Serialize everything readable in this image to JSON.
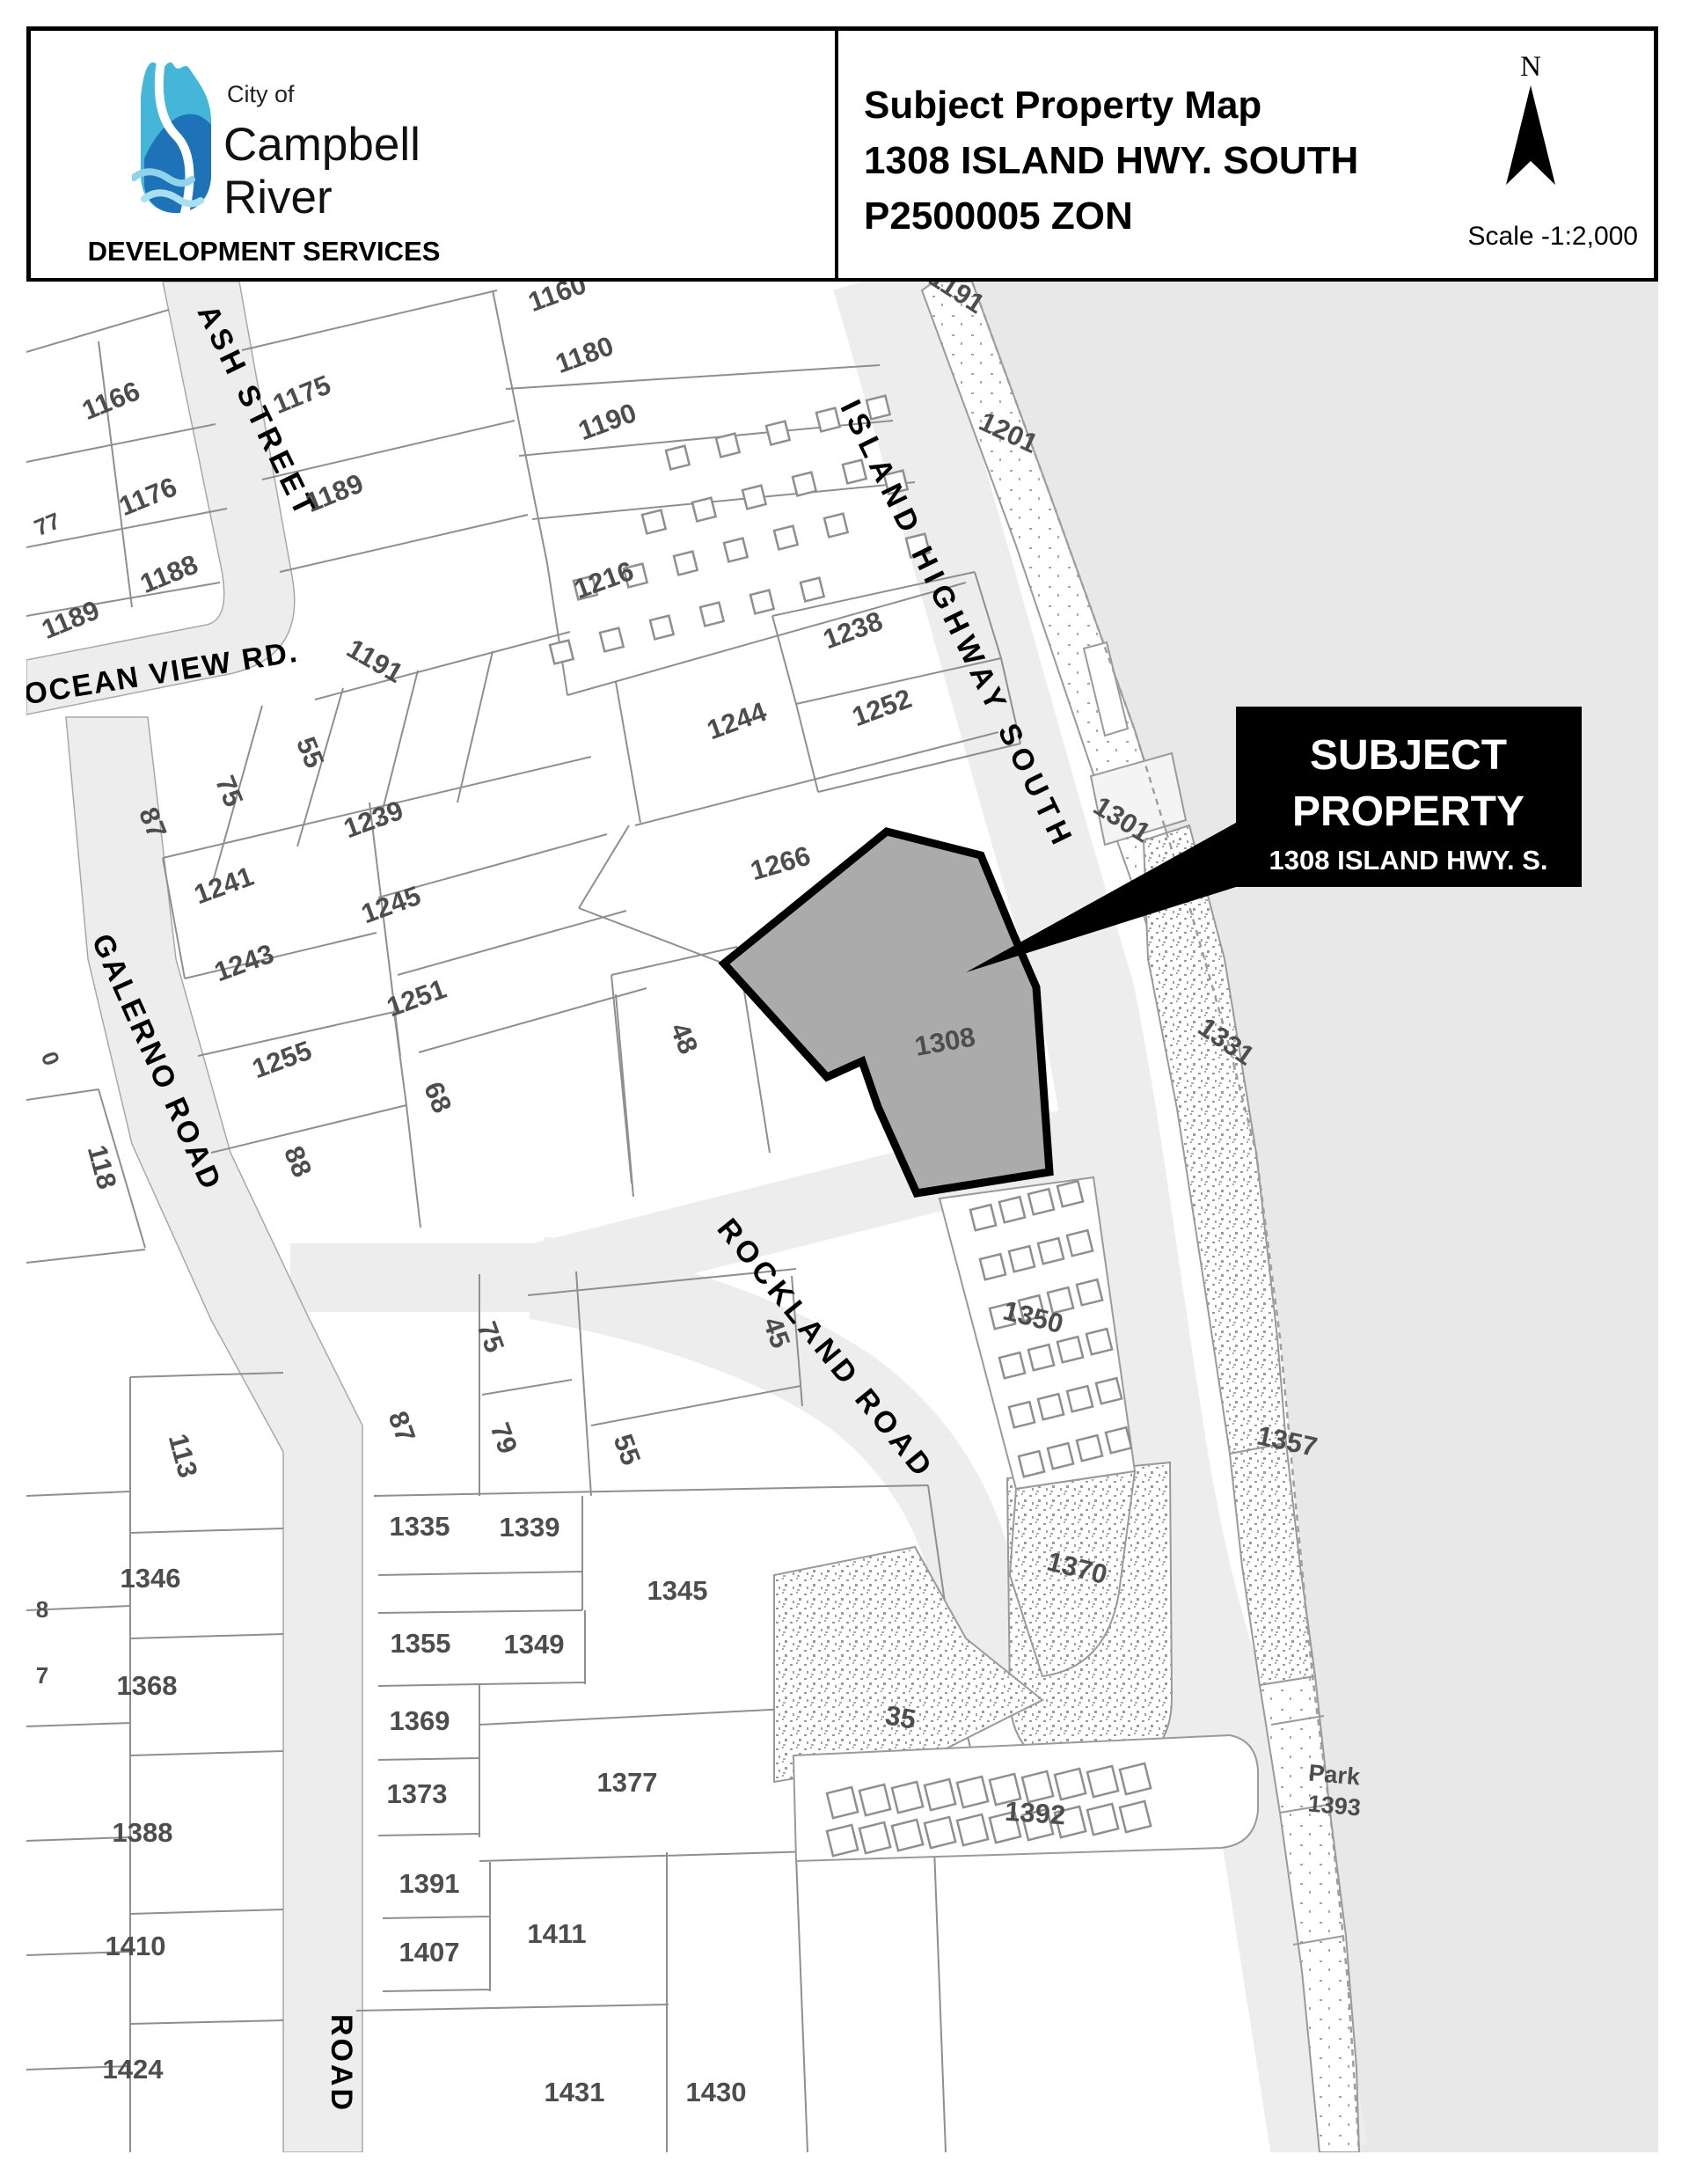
{
  "header": {
    "logo": {
      "city_of": "City of",
      "name_line1": "Campbell",
      "name_line2": "River",
      "department": "DEVELOPMENT SERVICES"
    },
    "title": {
      "line1": "Subject Property Map",
      "line2": "1308 ISLAND HWY. SOUTH",
      "line3": "P2500005 ZON"
    },
    "north_label": "N",
    "scale_label": "Scale -1:2,000"
  },
  "map": {
    "callout": {
      "line1": "SUBJECT",
      "line2": "PROPERTY",
      "line3": "1308 ISLAND HWY. S."
    },
    "subject_parcel_number": "1308",
    "streets": [
      {
        "id": "ash",
        "label": "ASH STREET"
      },
      {
        "id": "ocean_view",
        "label": "OCEAN VIEW RD."
      },
      {
        "id": "galerno",
        "label": "GALERNO ROAD"
      },
      {
        "id": "island_hwy",
        "label": "ISLAND HIGHWAY SOUTH"
      },
      {
        "id": "rockland",
        "label": "ROCKLAND ROAD"
      },
      {
        "id": "road",
        "label": "ROAD"
      }
    ],
    "parcel_labels": [
      {
        "id": "p77",
        "text": "77"
      },
      {
        "id": "p1166",
        "text": "1166"
      },
      {
        "id": "p1176",
        "text": "1176"
      },
      {
        "id": "p1188",
        "text": "1188"
      },
      {
        "id": "p1189a",
        "text": "1189"
      },
      {
        "id": "p1175",
        "text": "1175"
      },
      {
        "id": "p1189b",
        "text": "1189"
      },
      {
        "id": "p1160",
        "text": "1160"
      },
      {
        "id": "p1180",
        "text": "1180"
      },
      {
        "id": "p1190",
        "text": "1190"
      },
      {
        "id": "p1216",
        "text": "1216"
      },
      {
        "id": "p1191a",
        "text": "1191"
      },
      {
        "id": "p1201",
        "text": "1201"
      },
      {
        "id": "p1238",
        "text": "1238"
      },
      {
        "id": "p1252",
        "text": "1252"
      },
      {
        "id": "p1244",
        "text": "1244"
      },
      {
        "id": "p1266",
        "text": "1266"
      },
      {
        "id": "p1191b",
        "text": "1191"
      },
      {
        "id": "p55a",
        "text": "55"
      },
      {
        "id": "p75a",
        "text": "75"
      },
      {
        "id": "p87a",
        "text": "87"
      },
      {
        "id": "p1239",
        "text": "1239"
      },
      {
        "id": "p1241",
        "text": "1241"
      },
      {
        "id": "p1243",
        "text": "1243"
      },
      {
        "id": "p1245",
        "text": "1245"
      },
      {
        "id": "p1251",
        "text": "1251"
      },
      {
        "id": "p1255",
        "text": "1255"
      },
      {
        "id": "p0",
        "text": "0"
      },
      {
        "id": "p118",
        "text": "118"
      },
      {
        "id": "p88",
        "text": "88"
      },
      {
        "id": "p68",
        "text": "68"
      },
      {
        "id": "p48",
        "text": "48"
      },
      {
        "id": "p1301",
        "text": "1301"
      },
      {
        "id": "p1308",
        "text": "1308"
      },
      {
        "id": "p1331",
        "text": "1331"
      },
      {
        "id": "p1350",
        "text": "1350"
      },
      {
        "id": "p1357",
        "text": "1357"
      },
      {
        "id": "p45",
        "text": "45"
      },
      {
        "id": "p55b",
        "text": "55"
      },
      {
        "id": "p75b",
        "text": "75"
      },
      {
        "id": "p79",
        "text": "79"
      },
      {
        "id": "p87b",
        "text": "87"
      },
      {
        "id": "p113",
        "text": "113"
      },
      {
        "id": "p1335",
        "text": "1335"
      },
      {
        "id": "p1339",
        "text": "1339"
      },
      {
        "id": "p1345",
        "text": "1345"
      },
      {
        "id": "p1346",
        "text": "1346"
      },
      {
        "id": "p1355",
        "text": "1355"
      },
      {
        "id": "p1349",
        "text": "1349"
      },
      {
        "id": "p1368",
        "text": "1368"
      },
      {
        "id": "p1369",
        "text": "1369"
      },
      {
        "id": "p1373",
        "text": "1373"
      },
      {
        "id": "p1377",
        "text": "1377"
      },
      {
        "id": "p1388",
        "text": "1388"
      },
      {
        "id": "p1391",
        "text": "1391"
      },
      {
        "id": "p1407",
        "text": "1407"
      },
      {
        "id": "p1410",
        "text": "1410"
      },
      {
        "id": "p1411",
        "text": "1411"
      },
      {
        "id": "p1424",
        "text": "1424"
      },
      {
        "id": "p1431",
        "text": "1431"
      },
      {
        "id": "p1430",
        "text": "1430"
      },
      {
        "id": "p1370",
        "text": "1370"
      },
      {
        "id": "p35",
        "text": "35"
      },
      {
        "id": "p1392",
        "text": "1392"
      },
      {
        "id": "pPark",
        "text": "Park"
      },
      {
        "id": "p1393",
        "text": "1393"
      },
      {
        "id": "p8",
        "text": "8"
      },
      {
        "id": "p7",
        "text": "7"
      }
    ],
    "colors": {
      "water": "#e8e8e8",
      "road": "#ededed",
      "parcel_line": "#8f8f8f",
      "subject_fill": "#ababab",
      "label": "#4d4d4d",
      "callout_bg": "#000000",
      "callout_text": "#ffffff"
    }
  }
}
